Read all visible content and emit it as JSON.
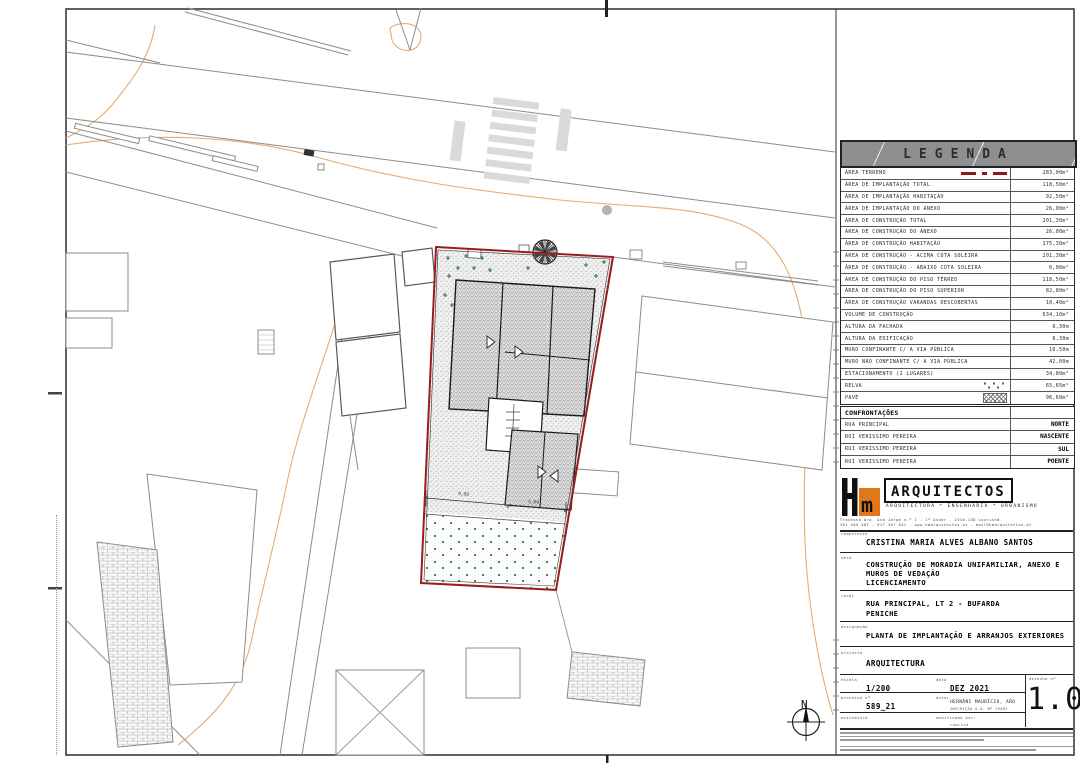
{
  "legend": {
    "title": "LEGENDA",
    "rows": [
      {
        "label": "ÁREA TERRENO",
        "value": "283,00m²",
        "symbol": "red-dashdot"
      },
      {
        "label": "ÁREA DE IMPLANTAÇÃO TOTAL",
        "value": "118,50m²",
        "symbol": null
      },
      {
        "label": "ÁREA DE IMPLANTAÇÃO HABITAÇÃO",
        "value": "92,50m²",
        "symbol": null
      },
      {
        "label": "ÁREA DE IMPLANTAÇÃO DO ANEXO",
        "value": "26,00m²",
        "symbol": null
      },
      {
        "label": "ÁREA DE CONSTRUÇÃO TOTAL",
        "value": "201,30m²",
        "symbol": null
      },
      {
        "label": "ÁREA DE CONSTRUÇÃO DO ANEXO",
        "value": "26,00m²",
        "symbol": null
      },
      {
        "label": "ÁREA DE CONSTRUÇÃO HABITAÇÃO",
        "value": "175,30m²",
        "symbol": null
      },
      {
        "label": "ÁREA DE CONSTRUÇÃO - ACIMA COTA SOLEIRA",
        "value": "201,30m²",
        "symbol": null
      },
      {
        "label": "ÁREA DE CONSTRUÇÃO - ABAIXO COTA SOLEIRA",
        "value": "0,00m²",
        "symbol": null
      },
      {
        "label": "ÁREA DE CONSTRUÇÃO DO PISO TÉRREO",
        "value": "118,50m²",
        "symbol": null
      },
      {
        "label": "ÁREA DE CONSTRUÇÃO DO PISO SUPERIOR",
        "value": "82,80m²",
        "symbol": null
      },
      {
        "label": "ÁREA DE CONSTRUÇÃO VARANDAS DESCOBERTAS",
        "value": "10,40m²",
        "symbol": null
      },
      {
        "label": "VOLUME DE CONSTRUÇÃO",
        "value": "634,10m³",
        "symbol": null
      },
      {
        "label": "ALTURA DA FACHADA",
        "value": "6,30m",
        "symbol": null
      },
      {
        "label": "ALTURA DA EDIFICAÇÃO",
        "value": "6,30m",
        "symbol": null
      },
      {
        "label": "MURO CONFINANTE C/ A VIA PÚBLICA",
        "value": "10,50m",
        "symbol": null
      },
      {
        "label": "MURO NÃO CONFINANTE C/ A VIA PÚBLICA",
        "value": "42,00m",
        "symbol": null
      },
      {
        "label": "ESTACIONAMENTO (2 LUGARES)",
        "value": "34,80m²",
        "symbol": null
      },
      {
        "label": "RELVA",
        "value": "65,65m²",
        "symbol": "grass"
      },
      {
        "label": "PAVÉ",
        "value": "96,60m²",
        "symbol": "pave"
      }
    ]
  },
  "confrontations": {
    "title": "CONFRONTAÇÕES",
    "rows": [
      {
        "side": "RUA PRINCIPAL",
        "direction": "NORTE"
      },
      {
        "side": "RUI VERISSIMO PEREIRA",
        "direction": "NASCENTE"
      },
      {
        "side": "RUI VERISSIMO PEREIRA",
        "direction": "SUL"
      },
      {
        "side": "RUI VERISSIMO PEREIRA",
        "direction": "POENTE"
      }
    ]
  },
  "firm": {
    "initials": "Hm",
    "name": "ARQUITECTOS",
    "tagline": "ARQUITECTURA * ENGENHARIA * URBANISMO",
    "address_line1": "Travessa Dra. Ana Jorge n.º 1 - 1º Andar - 2510-138 Lourinhã",
    "address_line2": "261 469 481 - 917 367 641 - www.hmarquitectos.pt - mail@hmarquitectos.pt"
  },
  "title_block": {
    "requerente_label": "requerente",
    "requerente": "CRISTINA MARIA ALVES ALBANO SANTOS",
    "obra_label": "obra",
    "obra_lines": [
      "CONSTRUÇÃO DE MORADIA UNIFAMILIAR, ANEXO E",
      "MUROS DE VEDAÇÃO",
      "LICENCIAMENTO"
    ],
    "local_label": "local",
    "local_lines": [
      "RUA PRINCIPAL, LT 2 - BUFARDA",
      "PENICHE"
    ],
    "designacao_label": "designação",
    "designacao": "PLANTA DE IMPLANTAÇÃO E ARRANJOS EXTERIORES",
    "projecto_label": "projecto",
    "projecto": "ARQUITECTURA",
    "escala_label": "escala",
    "escala": "1/200",
    "data_label": "data",
    "data": "DEZ 2021",
    "desenho_label": "desenho nº",
    "desenho": "1.00",
    "processo_label": "processo nº",
    "processo": "589_21",
    "autor_label": "autor",
    "autor_line1": "HERNÂNI MAURÍCIO, ARQ",
    "autor_line2": "INSCRIÇÃO O.A. Nº 19462",
    "assinatura_label": "assinatura",
    "modificado_label": "modificado por:",
    "rubrica_label": "rubrica"
  },
  "plan": {
    "north_label": "N",
    "dim_labels": [
      "9,98",
      "5,04"
    ],
    "boundary_color": "#9b1c1c",
    "grass_dot_color": "#2e7d32",
    "contour_color": "#e7ab6e"
  }
}
